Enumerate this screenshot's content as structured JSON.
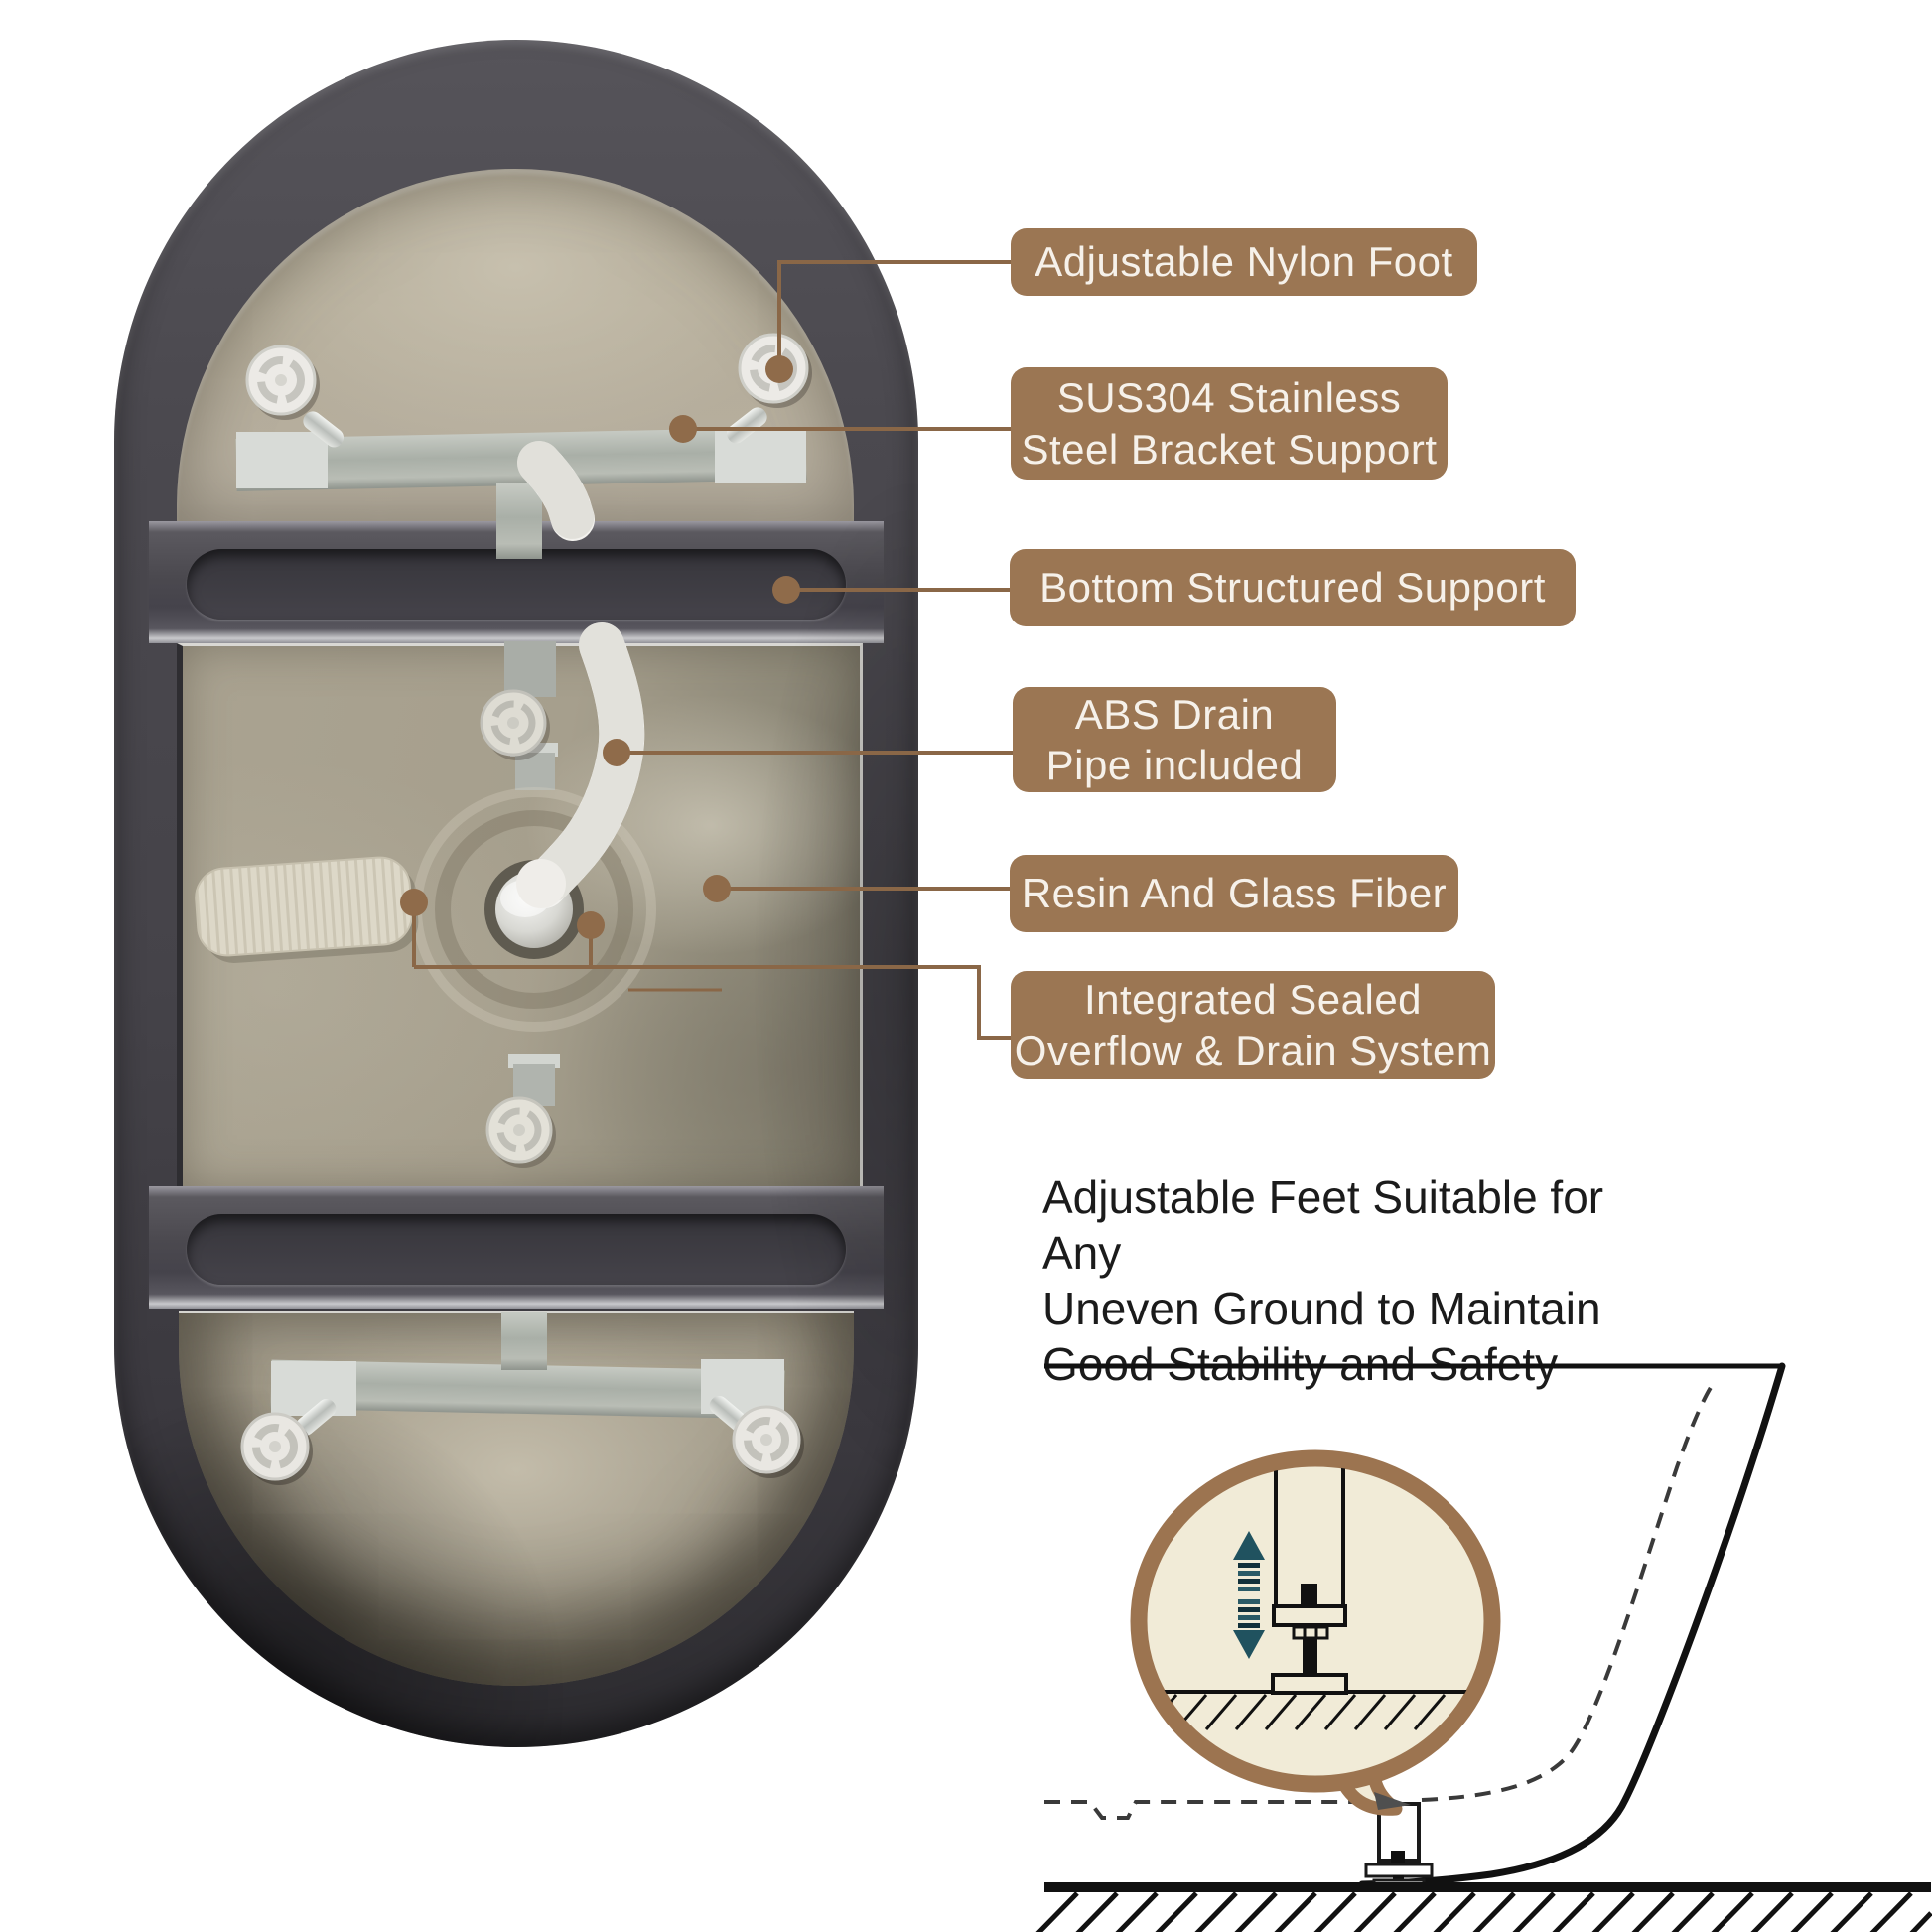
{
  "page": {
    "type": "bathtub-underside-product-infographic",
    "background": "#ffffff"
  },
  "colors": {
    "label_bg": "#9b7653",
    "label_text": "#f6f1ea",
    "callout_line": "#8a6747",
    "note_text": "#1b1b1b",
    "tub_rim_gray": "#46454b",
    "tub_interior_beige": "#b1a996",
    "bubble_fill": "#f1ebd7",
    "bubble_border": "#9c7450",
    "arrow_teal": "#1f505d"
  },
  "callouts": [
    {
      "name": "adjustable-nylon-foot",
      "label": "Adjustable Nylon Foot"
    },
    {
      "name": "sus304-stainless-steel-bracket-support",
      "label": "SUS304 Stainless\nSteel Bracket Support"
    },
    {
      "name": "bottom-structured-support",
      "label": "Bottom Structured Support"
    },
    {
      "name": "abs-drain-pipe-included",
      "label": "ABS Drain\nPipe included"
    },
    {
      "name": "resin-and-glass-fiber",
      "label": "Resin And Glass Fiber"
    },
    {
      "name": "integrated-sealed-overflow-drain-system",
      "label": "Integrated Sealed\nOverflow & Drain System"
    }
  ],
  "note": {
    "text": "Adjustable Feet Suitable for Any\nUneven Ground to Maintain\nGood Stability and Safety"
  },
  "icons": {
    "speech_bubble": "magnified-detail-speech-bubble",
    "up_down_arrows": "height-adjust-arrows",
    "ground_hatching": "ground-hatch-pattern"
  }
}
